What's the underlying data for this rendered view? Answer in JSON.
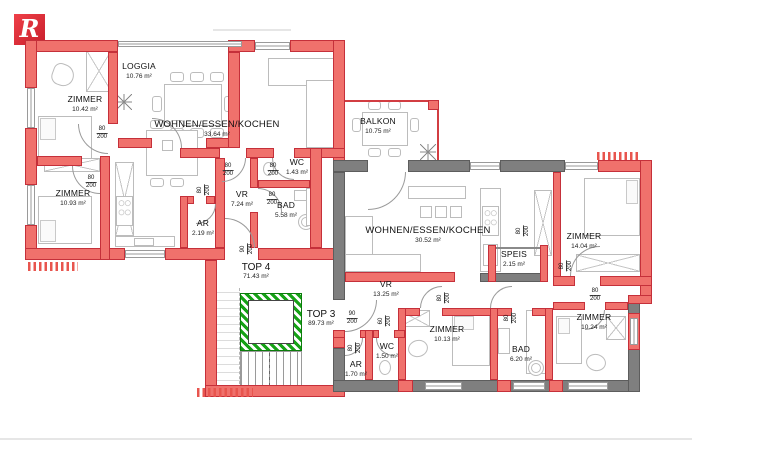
{
  "logo": {
    "letter": "R",
    "color": "#d6202e"
  },
  "colors": {
    "wall_red": "#f0716c",
    "wall_red_outline": "#c5303a",
    "wall_gray": "#7f7f7f",
    "elevator_green": "#16a216",
    "furniture_line": "#bcbcbc"
  },
  "units": {
    "top4": {
      "label": "TOP 4",
      "area": "71.43 m²"
    },
    "top3": {
      "label": "TOP 3",
      "area": "89.73 m²"
    }
  },
  "rooms": {
    "t4_zimmer1": {
      "name": "ZIMMER",
      "area": "10.42 m²"
    },
    "t4_loggia": {
      "name": "LOGGIA",
      "area": "10.76 m²"
    },
    "t4_wek": {
      "name": "WOHNEN/ESSEN/KOCHEN",
      "area": "33.64 m²"
    },
    "t4_zimmer2": {
      "name": "ZIMMER",
      "area": "10.93 m²"
    },
    "t4_ar": {
      "name": "AR",
      "area": "2.19 m²"
    },
    "t4_vr": {
      "name": "VR",
      "area": "7.24 m²"
    },
    "t4_wc": {
      "name": "WC",
      "area": "1.43 m²"
    },
    "t4_bad": {
      "name": "BAD",
      "area": "5.58 m²"
    },
    "t3_balkon": {
      "name": "BALKON",
      "area": "10.75 m²"
    },
    "t3_wek": {
      "name": "WOHNEN/ESSEN/KOCHEN",
      "area": "30.52 m²"
    },
    "t3_speis": {
      "name": "SPEIS",
      "area": "2.15 m²"
    },
    "t3_zimmer1": {
      "name": "ZIMMER",
      "area": "14.04 m²"
    },
    "t3_vr": {
      "name": "VR",
      "area": "13.25 m²"
    },
    "t3_ar": {
      "name": "AR",
      "area": "1.70 m²"
    },
    "t3_wc": {
      "name": "WC",
      "area": "1.50 m²"
    },
    "t3_zimmer2": {
      "name": "ZIMMER",
      "area": "10.13 m²"
    },
    "t3_bad": {
      "name": "BAD",
      "area": "6.20 m²"
    },
    "t3_zimmer3": {
      "name": "ZIMMER",
      "area": "10.24 m²"
    }
  },
  "doors": {
    "d60": {
      "width": "60",
      "height": "200"
    },
    "d80": {
      "width": "80",
      "height": "200"
    },
    "d90": {
      "width": "90",
      "height": "200"
    }
  }
}
